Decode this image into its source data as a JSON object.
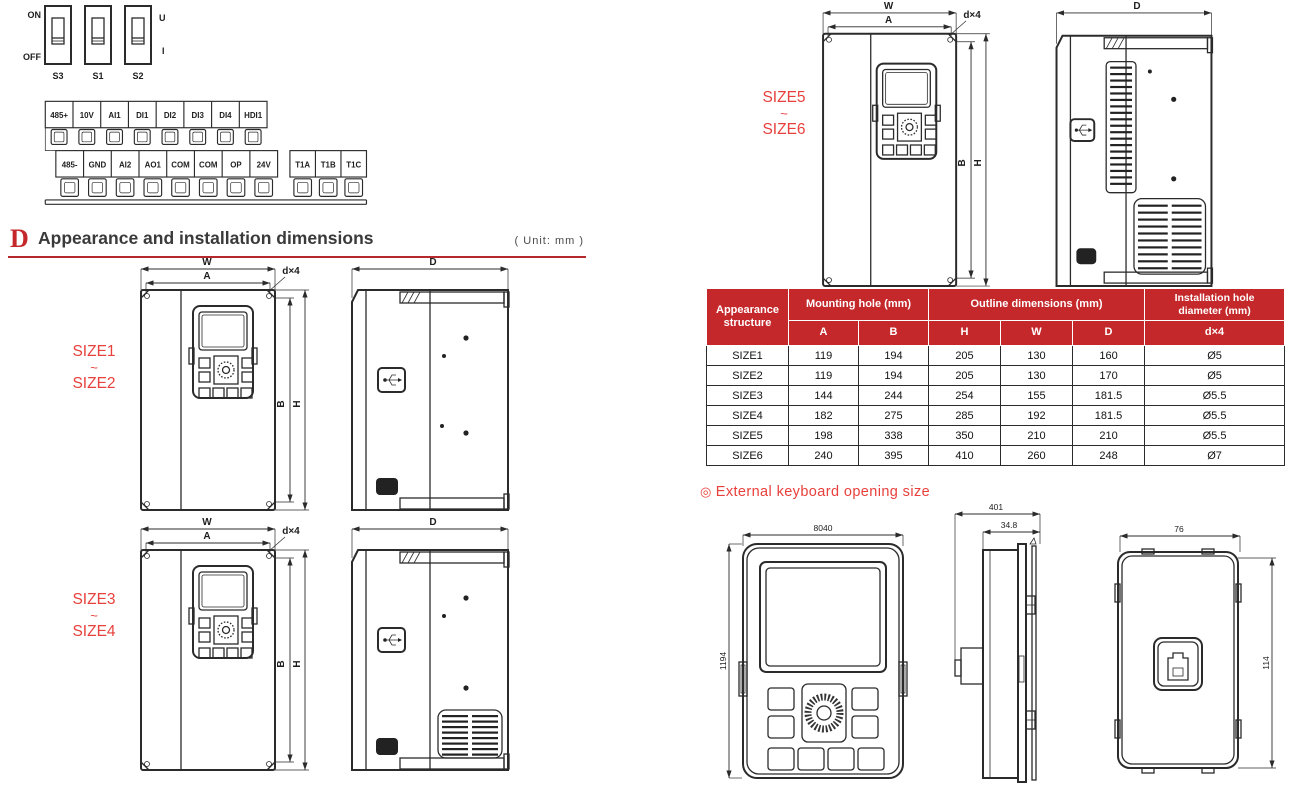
{
  "colors": {
    "accent_red": "#c4282b",
    "label_red": "#e8403c",
    "line_dark": "#2b2b2b"
  },
  "dip_figure": {
    "on": "ON",
    "off": "OFF",
    "u": "U",
    "i": "I",
    "switches": [
      "S3",
      "S1",
      "S2"
    ]
  },
  "terminal_figure": {
    "row1": [
      "485+",
      "10V",
      "AI1",
      "DI1",
      "DI2",
      "DI3",
      "DI4",
      "HDI1"
    ],
    "row2": [
      "485-",
      "GND",
      "AI2",
      "AO1",
      "COM",
      "COM",
      "OP",
      "24V"
    ],
    "relay": [
      "T1A",
      "T1B",
      "T1C"
    ]
  },
  "section_header": {
    "badge": "D",
    "title": "Appearance and installation dimensions",
    "unit": "( Unit: mm )"
  },
  "dimension_labels": {
    "w": "W",
    "a": "A",
    "d4": "d×4",
    "b": "B",
    "h": "H",
    "d": "D"
  },
  "size_groups": {
    "g12": {
      "top": "SIZE1",
      "tilde": "~",
      "bottom": "SIZE2"
    },
    "g34": {
      "top": "SIZE3",
      "tilde": "~",
      "bottom": "SIZE4"
    },
    "g56": {
      "top": "SIZE5",
      "tilde": "~",
      "bottom": "SIZE6"
    }
  },
  "table": {
    "corner_header": [
      "Appearance",
      "structure"
    ],
    "groups": [
      "Mounting hole (mm)",
      "Outline dimensions (mm)"
    ],
    "last_group": [
      "Installation hole",
      "diameter (mm)"
    ],
    "sub_headers": [
      "A",
      "B",
      "H",
      "W",
      "D",
      "d×4"
    ],
    "rows": [
      [
        "SIZE1",
        "119",
        "194",
        "205",
        "130",
        "160",
        "Ø5"
      ],
      [
        "SIZE2",
        "119",
        "194",
        "205",
        "130",
        "170",
        "Ø5"
      ],
      [
        "SIZE3",
        "144",
        "244",
        "254",
        "155",
        "181.5",
        "Ø5.5"
      ],
      [
        "SIZE4",
        "182",
        "275",
        "285",
        "192",
        "181.5",
        "Ø5.5"
      ],
      [
        "SIZE5",
        "198",
        "338",
        "350",
        "210",
        "210",
        "Ø5.5"
      ],
      [
        "SIZE6",
        "240",
        "395",
        "410",
        "260",
        "248",
        "Ø7"
      ]
    ]
  },
  "keyboard_section": {
    "bullet": "◎",
    "title": "External keyboard opening size",
    "front": {
      "width": "8040",
      "height": "1194"
    },
    "side": {
      "outer": "401",
      "inner": "34.8"
    },
    "back": {
      "width": "76",
      "height": "114"
    }
  }
}
